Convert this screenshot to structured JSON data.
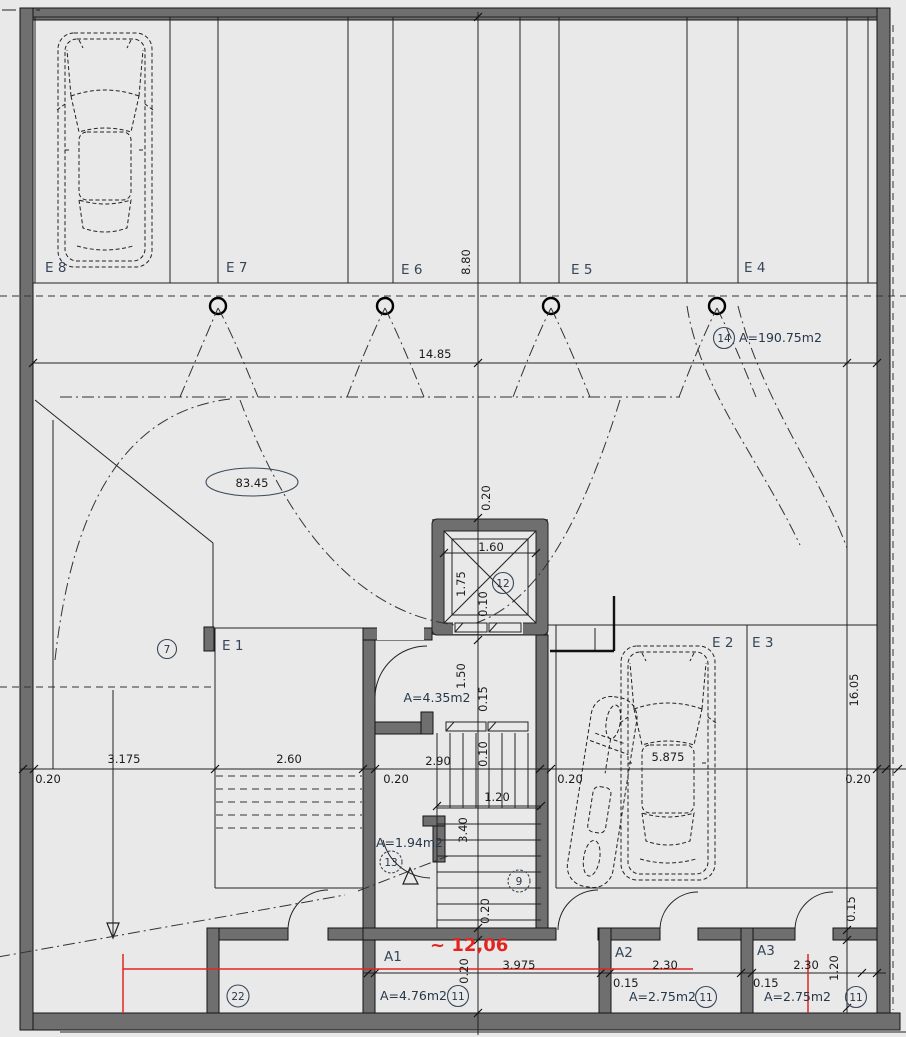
{
  "drawing_type": "basement-garage-floor-plan",
  "colors": {
    "wall": "#6f6f6f",
    "floor": "#e9e9e9",
    "line": "#222222",
    "label": "#36465a",
    "red": "#e12520"
  },
  "labels": {
    "e8": "E 8",
    "e7": "E 7",
    "e6": "E 6",
    "e5": "E 5",
    "e4": "E 4",
    "e1": "E 1",
    "e2": "E 2",
    "e3": "E 3",
    "a1": "A1",
    "a2": "A2",
    "a3": "A3"
  },
  "areas": {
    "garage": "A=190.75m2",
    "lobby": "A=4.35m2",
    "corridor": "A=1.94m2",
    "a1": "A=4.76m2",
    "a2": "A=2.75m2",
    "a3": "A=2.75m2"
  },
  "refs": {
    "garage": "14",
    "elevator": "12",
    "left_column": "7",
    "corridor": "13",
    "stair": "9",
    "room22": "22",
    "a1": "11",
    "a2": "11",
    "a3": "11"
  },
  "dims": {
    "top_depth": "8.80",
    "top_width": "14.85",
    "drive_area": "83.45",
    "shaft_top_wall": "0.20",
    "elev_width": "1.60",
    "elev_depth": "1.75",
    "elev_wall": "0.10",
    "lobby_depth": "1.50",
    "lobby_wall": "0.15",
    "right_depth": "16.05",
    "left_wall": "0.20",
    "bay_left": "3.175",
    "bay_e1": "2.60",
    "core_wall_left": "0.20",
    "lobby_width": "2.90",
    "stair_wall": "0.10",
    "core_wall_right": "0.20",
    "bay_e2": "5.875",
    "right_wall": "0.20",
    "stair_width": "1.20",
    "stair_length": "3.40",
    "storage_wall_top": "0.20",
    "storage_wall_bottom": "0.20",
    "a1_width": "3.975",
    "a2_wall": "0.15",
    "a2_width": "2.30",
    "a3_wall": "0.15",
    "a3_width": "2.30",
    "storage_depth": "1.20",
    "right_wall_thin": "0.15"
  },
  "red": {
    "level": "~ 12,06"
  }
}
